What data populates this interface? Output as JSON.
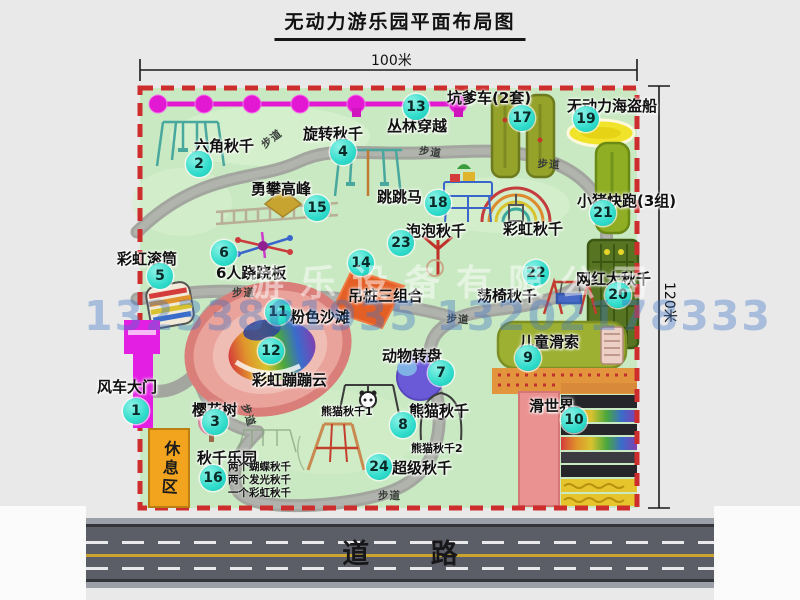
{
  "title": "无动力游乐园平面布局图",
  "dimensions": {
    "width_label": "100米",
    "height_label": "120米"
  },
  "road_label": "道 路",
  "path_label": "步道",
  "rest_area_label": "休息区",
  "watermark": {
    "company": "游乐设备有限公司",
    "phone": "13233861935 13202178333"
  },
  "facilities": [
    {
      "num": "1",
      "name": "风车大门"
    },
    {
      "num": "2",
      "name": "六角秋千"
    },
    {
      "num": "3",
      "name": "樱花树"
    },
    {
      "num": "4",
      "name": "旋转秋千"
    },
    {
      "num": "5",
      "name": "彩虹滚筒"
    },
    {
      "num": "6",
      "name": "6人跷跷板"
    },
    {
      "num": "7",
      "name": "动物转盘"
    },
    {
      "num": "8",
      "name": "熊猫秋千"
    },
    {
      "num": "9",
      "name": "儿童滑索"
    },
    {
      "num": "10",
      "name": "滑世界"
    },
    {
      "num": "11",
      "name": "粉色沙滩"
    },
    {
      "num": "12",
      "name": "彩虹蹦蹦云"
    },
    {
      "num": "13",
      "name": "丛林穿越"
    },
    {
      "num": "14",
      "name": "吊桩三组合"
    },
    {
      "num": "15",
      "name": "勇攀高峰"
    },
    {
      "num": "16",
      "name": "秋千乐园"
    },
    {
      "num": "17",
      "name": "坑爹车(2套)"
    },
    {
      "num": "18",
      "name": "跳跳马"
    },
    {
      "num": "19",
      "name": "无动力海盗船"
    },
    {
      "num": "20",
      "name": "网红大秋千"
    },
    {
      "num": "21",
      "name": "小猪快跑(3组)"
    },
    {
      "num": "22",
      "name": "荡椅秋千"
    },
    {
      "num": "23",
      "name": "泡泡秋千"
    },
    {
      "num": "24",
      "name": "超级秋千"
    }
  ],
  "annotations": {
    "rainbow_swing": "彩虹秋千",
    "panda_swing_1": "熊猫秋千1",
    "panda_swing_2": "熊猫秋千2",
    "swing_park_items": [
      "两个蝴蝶秋千",
      "两个发光秋千",
      "一个彩虹秋千"
    ]
  },
  "colors": {
    "park_green": "#c9e9c2",
    "boundary_dash_red": "#ce2d2d",
    "zipline_magenta": "#e318d2",
    "gate_magenta": "#e21fe2",
    "badge_teal": "#30dccb",
    "rest_area_orange": "#f3a41e",
    "road_gray": "#5c5e67",
    "lane_yellow": "#c9a42e"
  }
}
